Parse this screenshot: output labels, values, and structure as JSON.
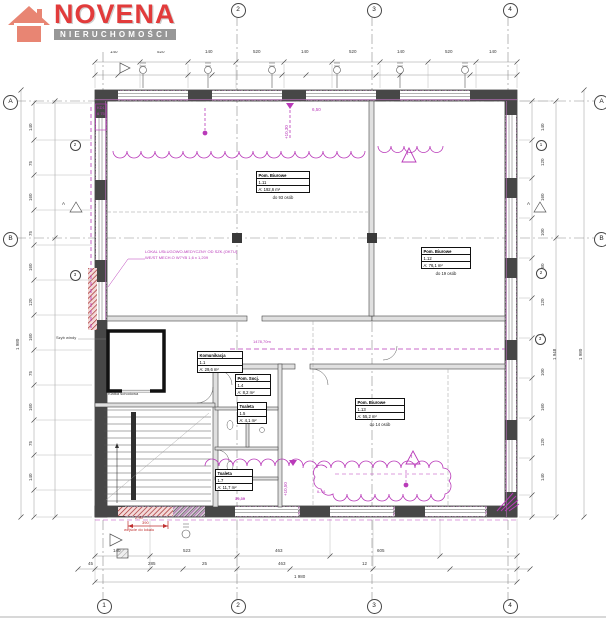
{
  "logo": {
    "brand": "NOVENA",
    "tagline": "NIERUCHOMOŚCI",
    "brand_color": "#e23b3b",
    "house_color": "#e88573",
    "tagline_bg": "#979797"
  },
  "grid": {
    "top": [
      "1",
      "2",
      "3",
      "4"
    ],
    "bottom": [
      "1",
      "2",
      "3",
      "4"
    ],
    "left": [
      "A",
      "B"
    ],
    "right": [
      "A",
      "B"
    ]
  },
  "tags": {
    "left": [
      "2",
      "3"
    ],
    "right": [
      "1",
      "2",
      "3"
    ],
    "section_marker": "A"
  },
  "rooms": [
    {
      "name": "Pom. Biurowe",
      "number": "1.11",
      "area": "A: 192,6 m²",
      "capacity": "do 93 osób"
    },
    {
      "name": "Pom. Biurowe",
      "number": "1.12",
      "area": "A: 76,1 m²",
      "capacity": "do 19 osób"
    },
    {
      "name": "Pom. Biurowe",
      "number": "1.13",
      "area": "A: 55,2 m²",
      "capacity": "do 14 osób"
    },
    {
      "name": "Komunikacja",
      "number": "1.1",
      "area": "A: 29,6 m²",
      "capacity": ""
    },
    {
      "name": "Pom. Socj.",
      "number": "1.4",
      "area": "A: 8,2 m²",
      "capacity": ""
    },
    {
      "name": "Toaleta",
      "number": "1.5",
      "area": "A: 4,1 m²",
      "capacity": ""
    },
    {
      "name": "Toaleta",
      "number": "1.7",
      "area": "A: 11,7 m²",
      "capacity": ""
    }
  ],
  "labels": {
    "stairs": "Klatka schodowa",
    "shaft": "Szyb windy"
  },
  "annotations": {
    "level_top": "+10,30",
    "span_value": "6,50",
    "kd1": "KD1",
    "kd1_value": "6 75",
    "note_line1": "LOKAL USŁUGOWO-MEDYCZNY OD SZK.(OKTU)",
    "note_line2": "WE/ST MECH.O W7YB 1,6 x 1,209",
    "corridor_length": "1478,70m",
    "level_bottom": "+10,50",
    "cloud_label": "IL.91",
    "small_value": "39,39",
    "entrance_level": "2,90",
    "entrance_dim": "390",
    "entrance_note": "wejście do lokalu",
    "warning": "!"
  },
  "dims": {
    "top": [
      "140",
      "520",
      "140",
      "520",
      "140",
      "520",
      "140",
      "520",
      "140"
    ],
    "left": [
      "140",
      "75",
      "160",
      "75",
      "160",
      "120",
      "160",
      "75",
      "160",
      "75",
      "140"
    ],
    "left_total": "1 980",
    "right": [
      "140",
      "120",
      "160",
      "100",
      "160",
      "120",
      "160",
      "100",
      "160",
      "120",
      "140"
    ],
    "right_total_inner": "1 948",
    "right_total_outer": "1 980",
    "bottom_row1": [
      "140",
      "523",
      "463",
      "605"
    ],
    "bottom_row2": [
      "45",
      "285",
      "25",
      "463",
      "12"
    ],
    "bottom_total": "1 980"
  },
  "colors": {
    "annotation_magenta": "#b93ab9",
    "accent_red": "#c03030",
    "wall_dark": "#474747"
  }
}
